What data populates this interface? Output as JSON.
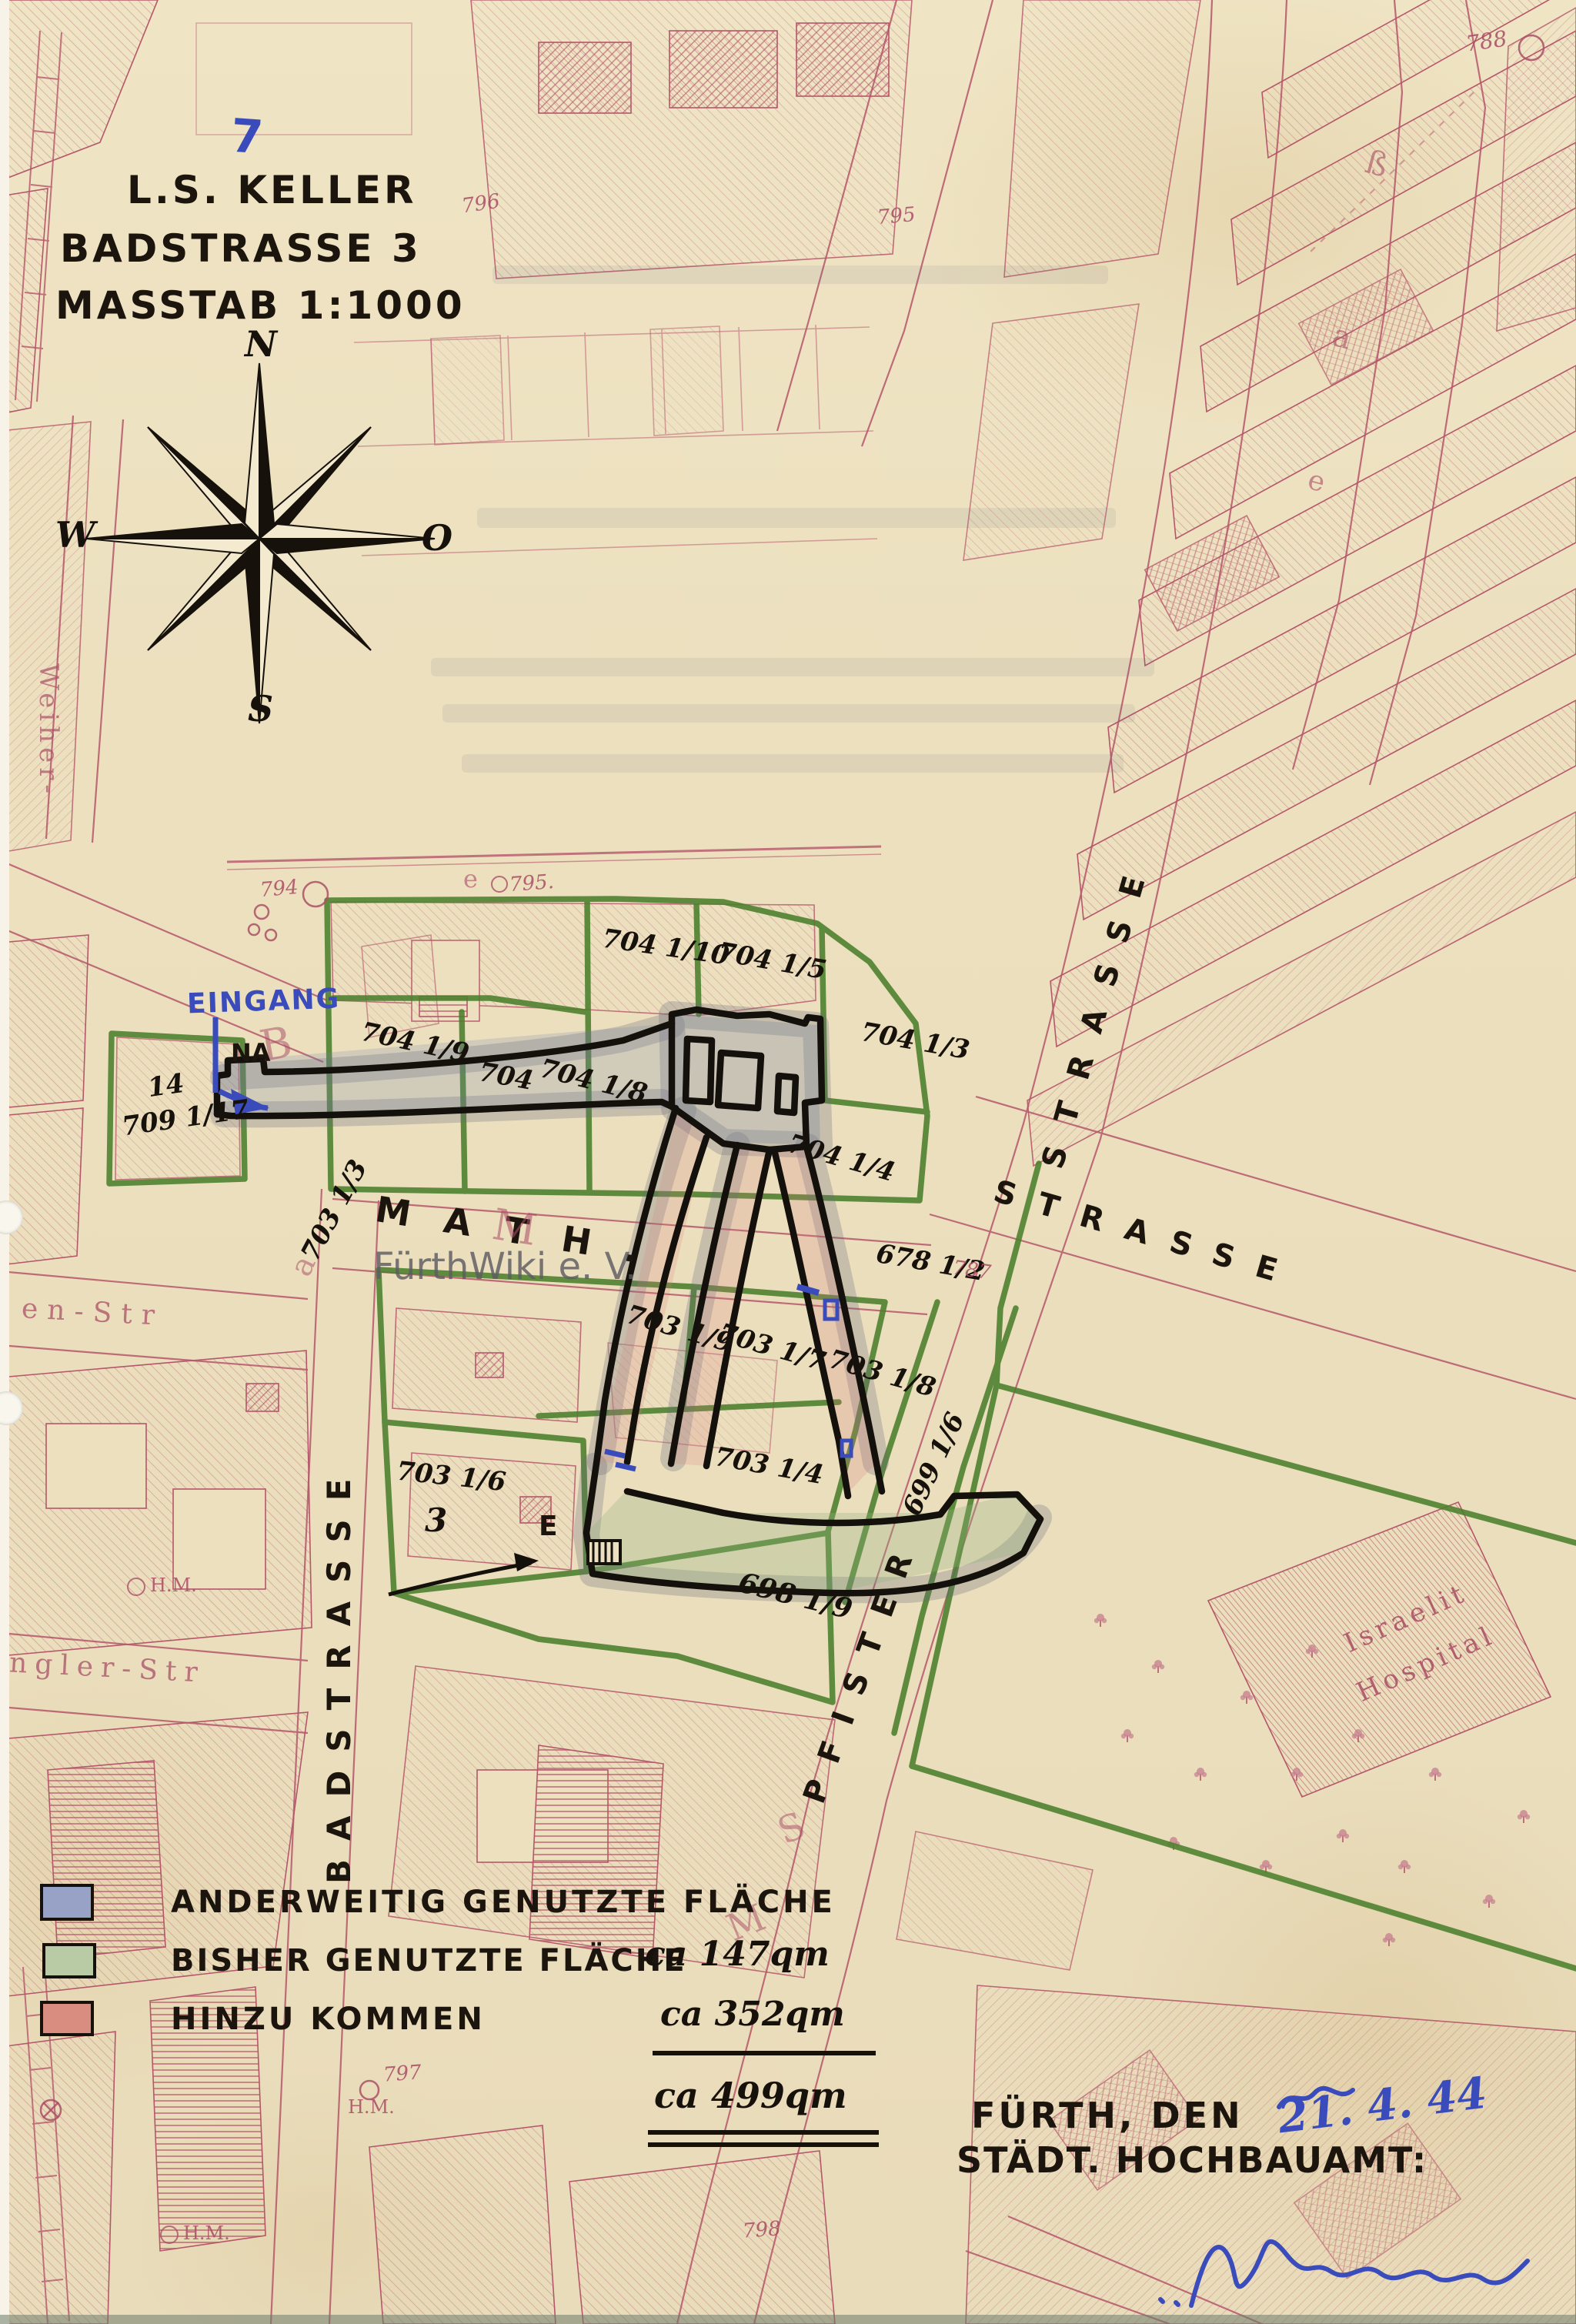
{
  "page": {
    "number": "7"
  },
  "title": {
    "line1": "L.S. KELLER",
    "line2": "BADSTRASSE 3",
    "line3": "MASSTAB 1:1000"
  },
  "compass": {
    "north": "N",
    "west": "W",
    "east": "O",
    "south": "S"
  },
  "streets": {
    "math": "M A T H .",
    "math_strasse": "STRASSE",
    "badstrasse": "BADSTRASSE",
    "pfister": "PFISTER",
    "pfister_strasse": "STRASSE",
    "weiher": "Weiher-",
    "en_str": "en-Str",
    "ngler_str": "ngler-Str",
    "ghost": {
      "b": "B",
      "a_bad": "a",
      "s_pf": "S",
      "m_pf": "M",
      "m_math": "M",
      "beta": "ß",
      "a_r": "a",
      "e_r": "e",
      "e_mid": "e"
    }
  },
  "annotations": {
    "eingang": "EINGANG",
    "na": "NA",
    "e_label": "E",
    "date": "21. 4. 44"
  },
  "parcels": {
    "p709": "709 1/17",
    "p14": "14",
    "p704_9": "704 1/9",
    "p704": "704",
    "p704_8": "704 1/8",
    "p704_10": "704 1/10",
    "p704_5": "704 1/5",
    "p704_3": "704 1/3",
    "p704_4": "704 1/4",
    "p678": "678 1/2",
    "p703_9": "703 1/9",
    "p703_7": "703 1/7",
    "p703_8": "703 1/8",
    "p703_4": "703 1/4",
    "p703_6": "703 1/6",
    "p703_6b": "3",
    "p703_3": "703 1/3",
    "p698": "698 1/9",
    "p699": "699 1/6"
  },
  "map_numbers": {
    "n794": "794",
    "n795a": "795.",
    "n795b": "795",
    "n796": "796",
    "n787": "787",
    "n788": "788",
    "n797": "797",
    "n798": "798",
    "hm1": "H.M.",
    "hm2": "H.M.",
    "hm3": "H.M."
  },
  "legend": {
    "rows": [
      {
        "label": "ANDERWEITIG GENUTZTE FLÄCHE",
        "value": "",
        "color": "#98a2c6",
        "swatch_style": "background:#98a2c6"
      },
      {
        "label": "BISHER GENUTZTE FLÄCHE",
        "value": "ca 147qm",
        "color": "#b9cba4",
        "swatch_style": "background:#b9cba4"
      },
      {
        "label": "HINZU KOMMEN",
        "value": "ca 352qm",
        "color": "#d88d80",
        "swatch_style": "background:#d88d80"
      }
    ],
    "total": "ca 499qm"
  },
  "footer": {
    "city_line": "FÜRTH, DEN",
    "office_line": "STÄDT. HOCHBAUAMT:"
  },
  "watermark": "FürthWiki e. V.",
  "hospital": {
    "line1": "Israelit",
    "line2": "Hospital"
  },
  "colors": {
    "paper": "#ece0bf",
    "map_pink": "#b5576b",
    "parcel_green": "#4b7f2c",
    "ink_blue": "#3a4cbb",
    "ink_black": "#17110b"
  }
}
